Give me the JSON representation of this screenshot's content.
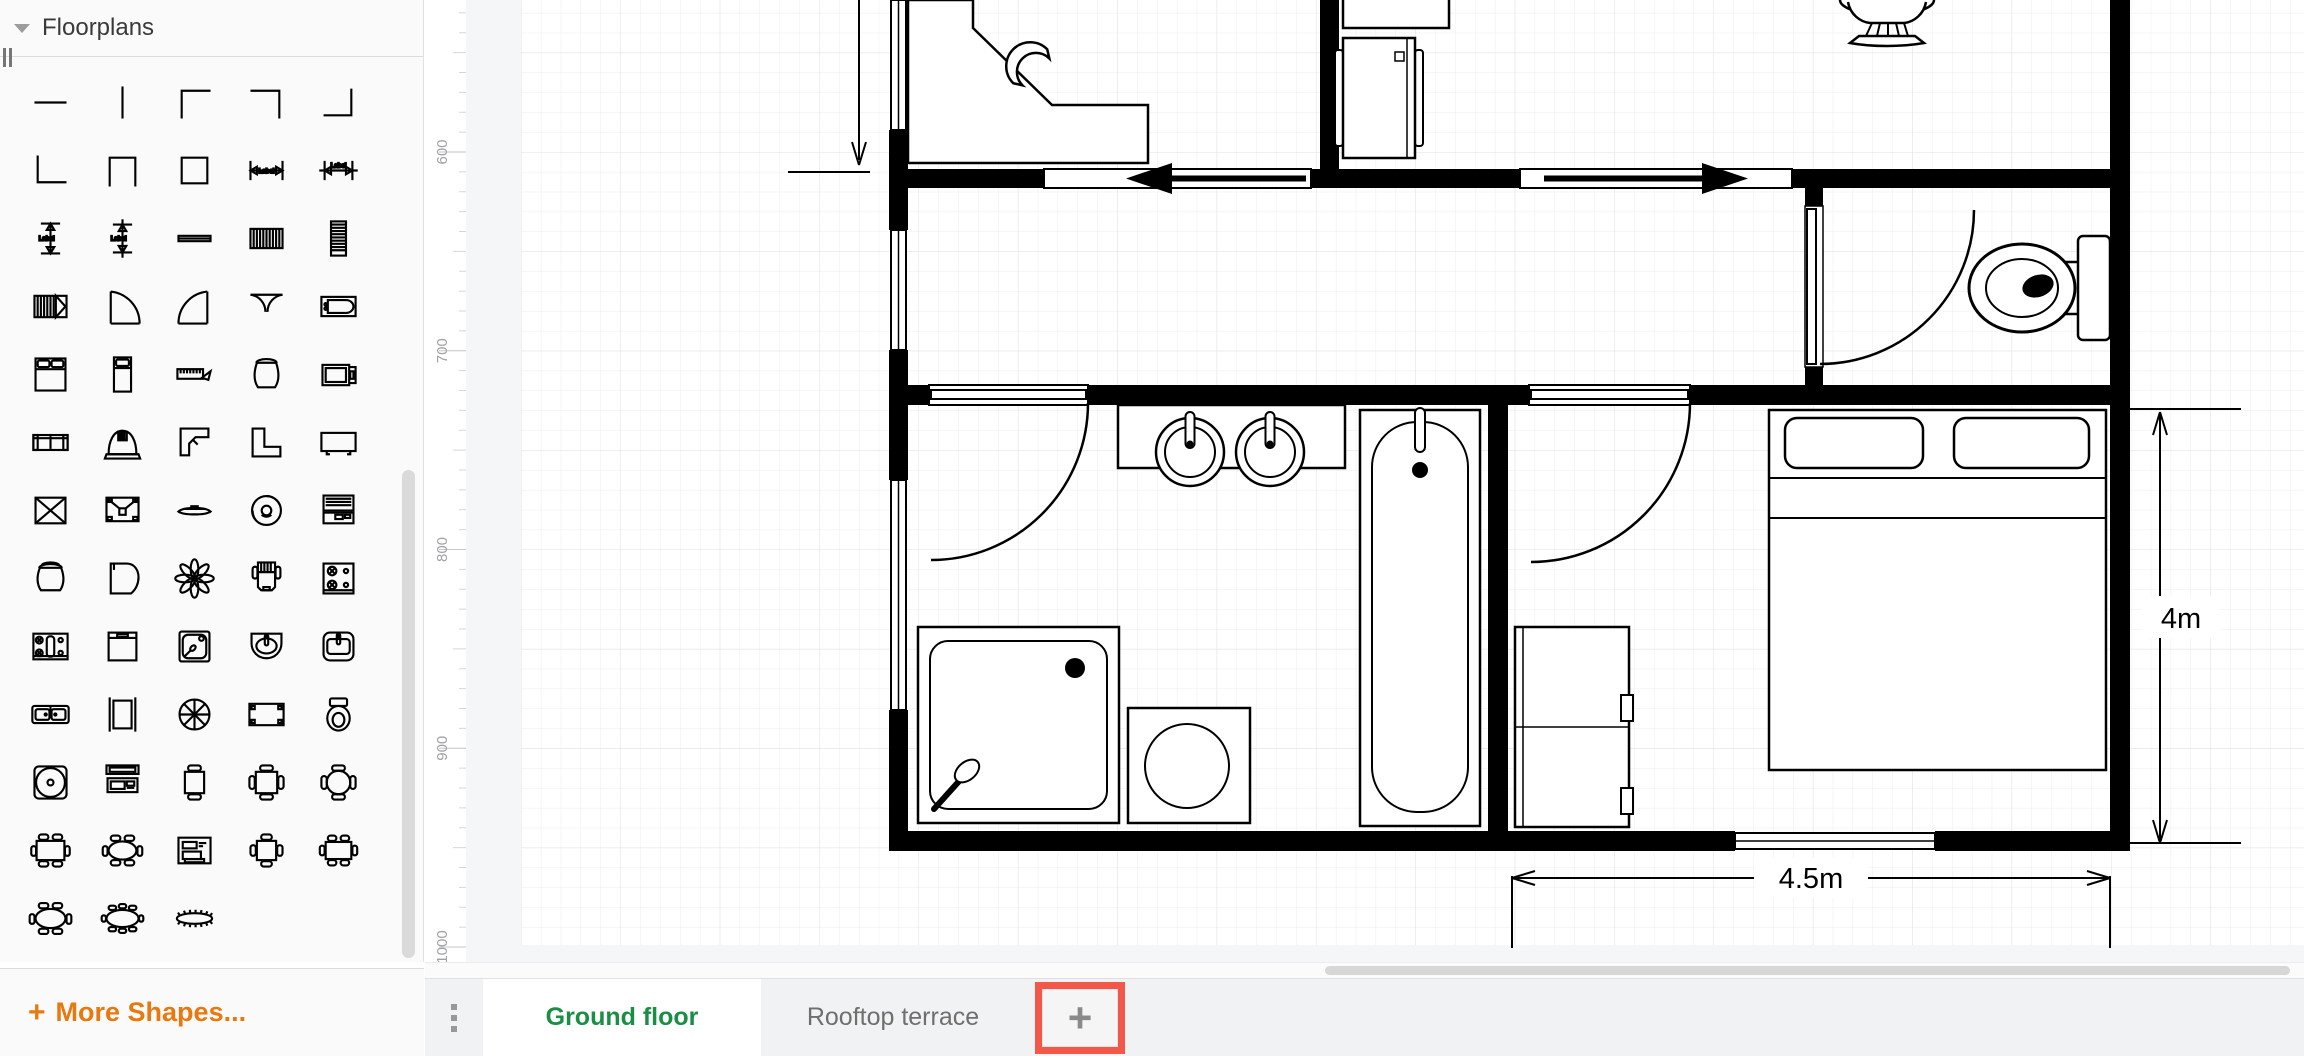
{
  "sidebar": {
    "section_title": "Floorplans",
    "more_shapes_label": "More Shapes...",
    "plus_icon": "+",
    "dimension_label_text": "Label",
    "shapes": [
      "wall-horizontal",
      "wall-vertical",
      "wall-corner-nw",
      "wall-corner-ne",
      "wall-corner-se",
      "wall-corner-sw",
      "wall-u",
      "room",
      "dimension-horizontal",
      "dimension-horizontal-alt",
      "dimension-vertical",
      "dimension-vertical-alt",
      "wall-thin",
      "stairs-horizontal",
      "stairs-vertical",
      "stairs-directional",
      "door",
      "door-wide",
      "double-door",
      "bathtub",
      "bed-double",
      "bed-single",
      "scale-ruler",
      "armchair",
      "tv-cabinet",
      "couch",
      "fireplace",
      "desk-corner",
      "counter-corner",
      "flat-tv",
      "window-crossed",
      "speaker",
      "table-low",
      "ceiling-fan",
      "laptop",
      "laundry-basket",
      "piano",
      "plant-flower",
      "office-chair",
      "stove",
      "kitchen-unit",
      "cabinet",
      "shower",
      "sink-round",
      "sink-square",
      "sink-double",
      "elevator",
      "spiral-stairs",
      "table",
      "toilet",
      "round-rug",
      "workstation",
      "table-2-chairs",
      "table-4-chairs",
      "round-table-4-chairs",
      "table-6-chairs",
      "oval-table-4-chairs",
      "copier",
      "square-table-4-chairs",
      "table-6-chairs-alt",
      "oval-table-6-chairs",
      "conference-table",
      "long-conference-table"
    ]
  },
  "ruler": {
    "labels": [
      "600",
      "700",
      "800",
      "900",
      "1000"
    ]
  },
  "canvas": {
    "dimensions": {
      "bedroom_height": "4m",
      "bedroom_width": "4.5m"
    }
  },
  "footer": {
    "pages_menu_icon": "vertical-dots-icon",
    "tabs": [
      {
        "label": "Ground floor",
        "active": true
      },
      {
        "label": "Rooftop terrace",
        "active": false
      }
    ],
    "add_page_label": "+"
  },
  "colors": {
    "accent_orange": "#e8790f",
    "active_tab_green": "#1a8e44",
    "highlight_red": "#f25749",
    "wall_black": "#000000"
  }
}
